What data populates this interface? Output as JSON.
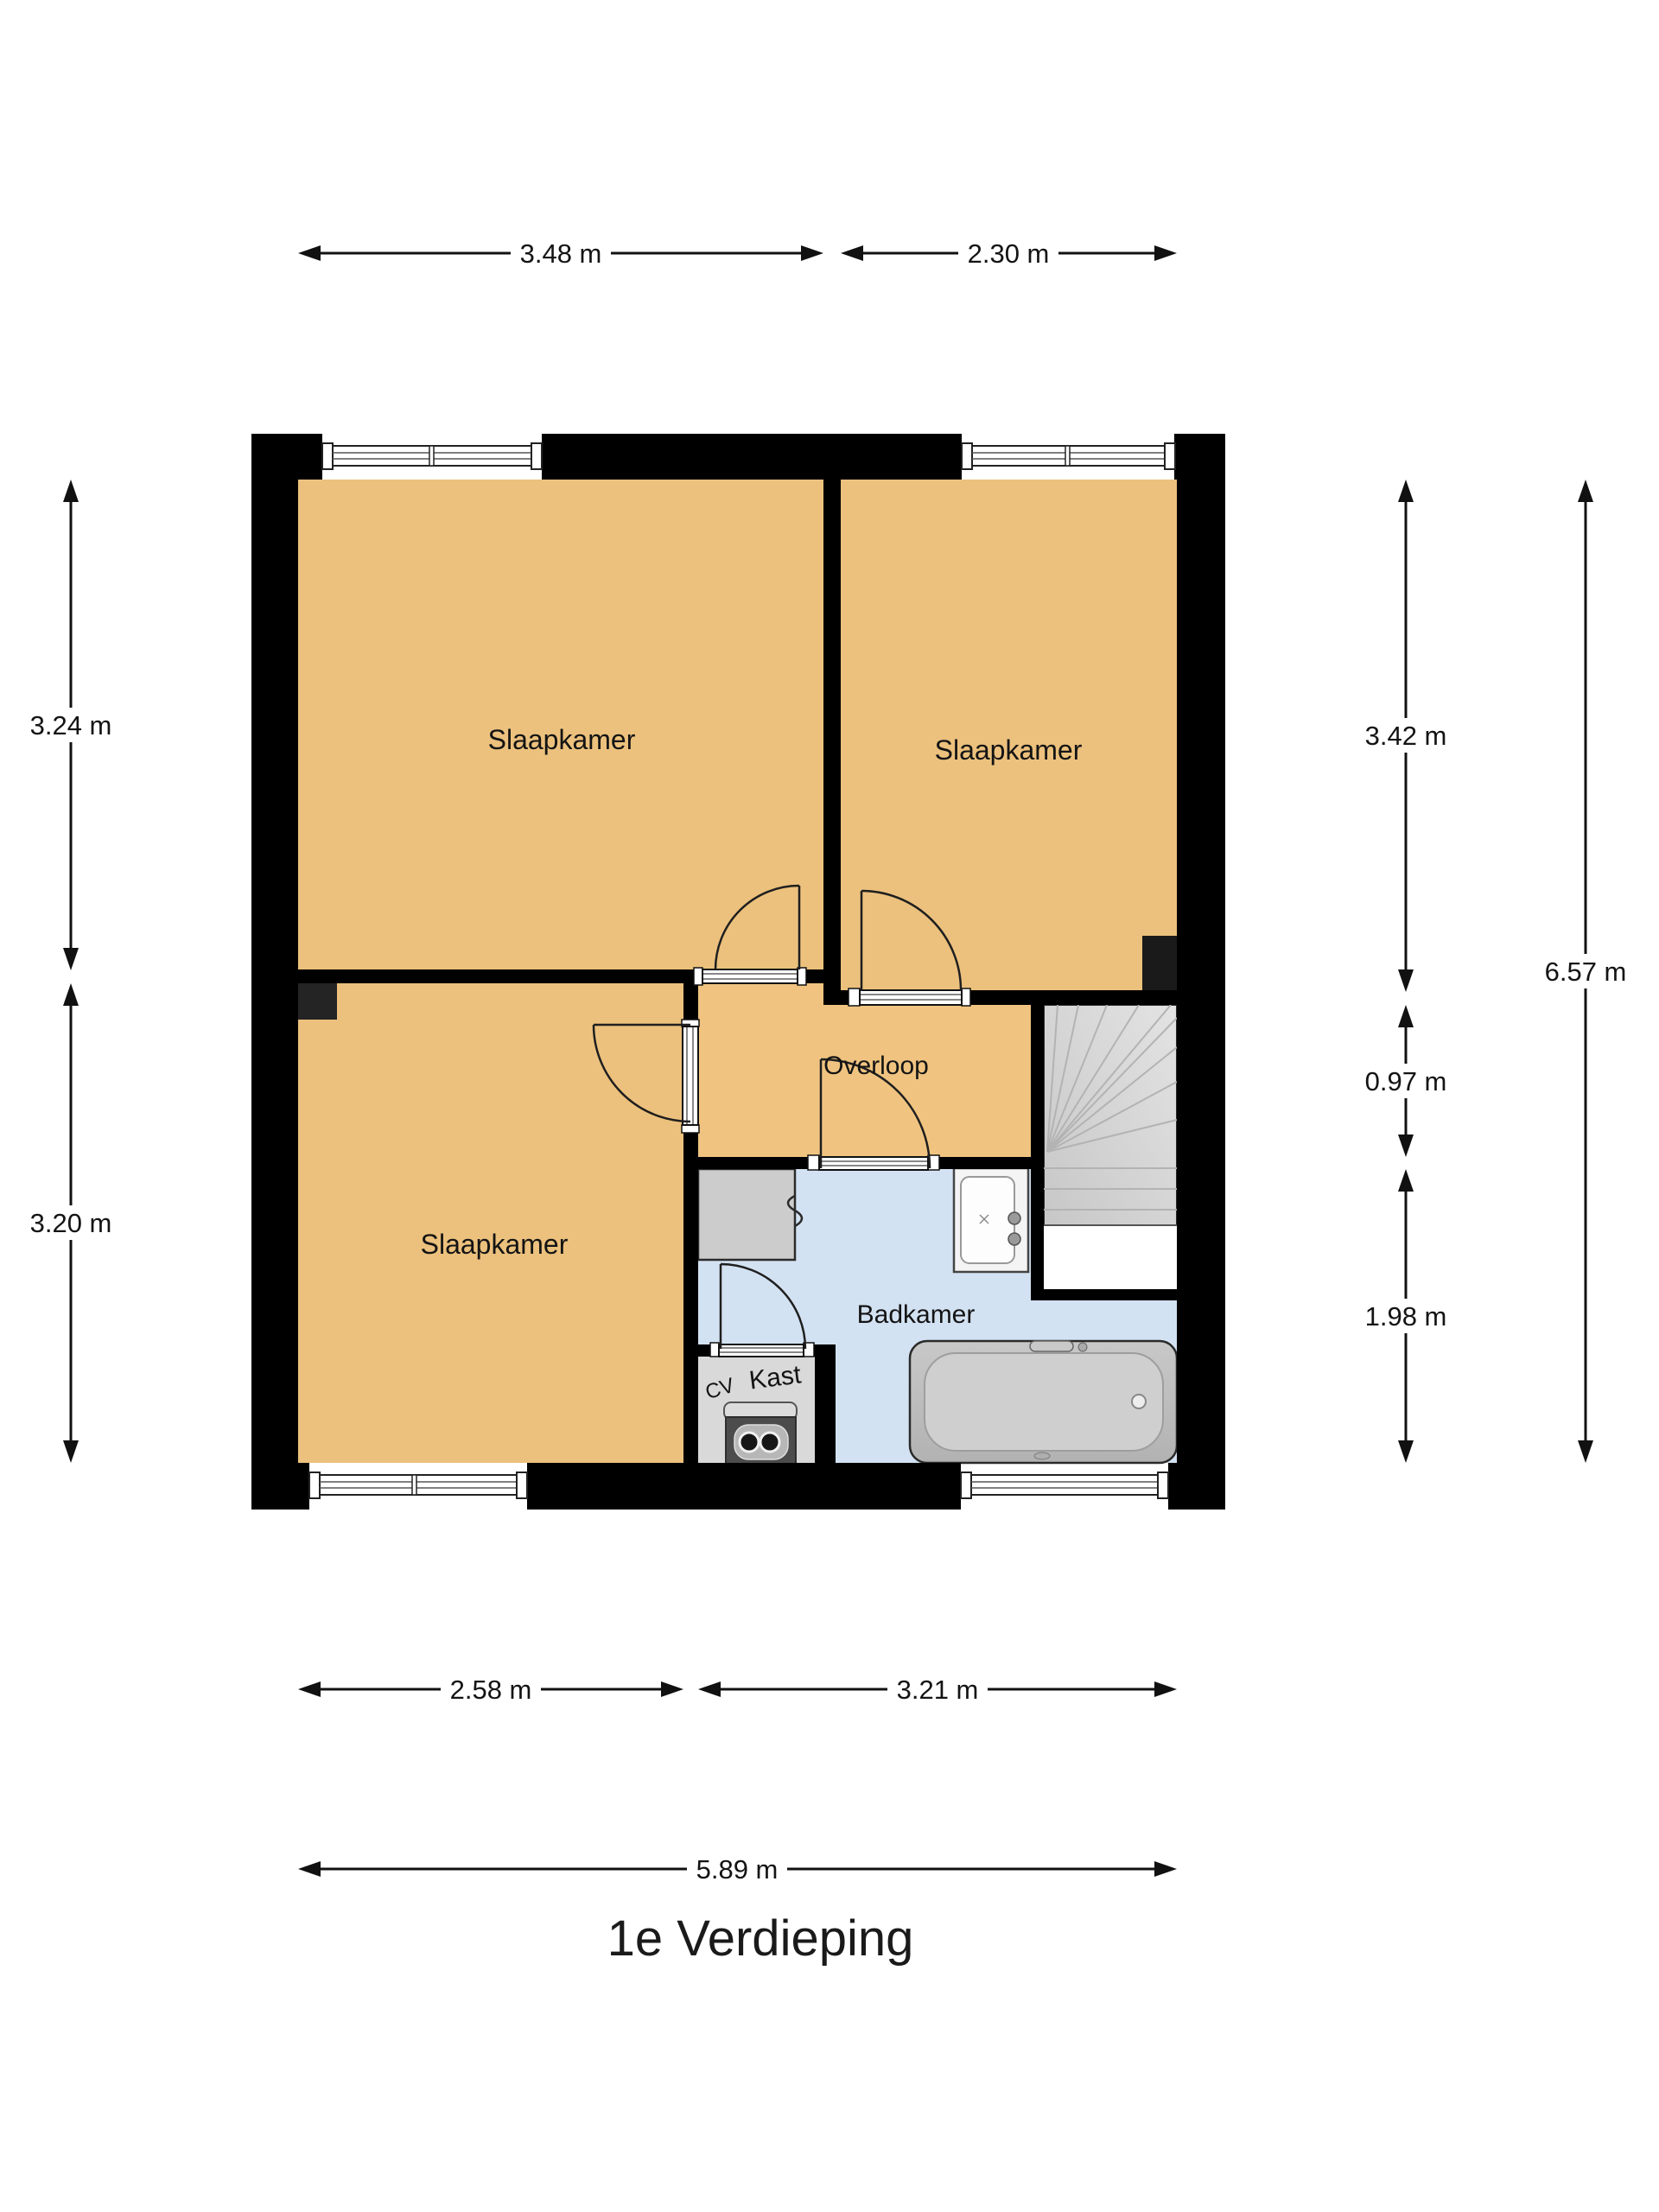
{
  "floorplan": {
    "title": "1e Verdieping",
    "labels": {
      "bedroom_tl": "Slaapkamer",
      "bedroom_tr": "Slaapkamer",
      "bedroom_bl": "Slaapkamer",
      "landing": "Overloop",
      "bathroom": "Badkamer",
      "closet": "Kast",
      "boiler": "CV"
    },
    "dimensions": {
      "top_left": "3.48 m",
      "top_right": "2.30 m",
      "left_upper": "3.24 m",
      "left_lower": "3.20 m",
      "right_upper": "3.42 m",
      "right_middle": "0.97 m",
      "right_lower": "1.98 m",
      "right_total": "6.57 m",
      "bottom_left": "2.58 m",
      "bottom_right": "3.21 m",
      "bottom_total": "5.89 m"
    },
    "colors": {
      "wall": "#000000",
      "room_floor": "#ecc17d",
      "bathroom_floor": "#d3e2f2",
      "closet_floor": "#d9d9d9",
      "stairs": "#d6d6d6",
      "background": "#ffffff"
    }
  }
}
